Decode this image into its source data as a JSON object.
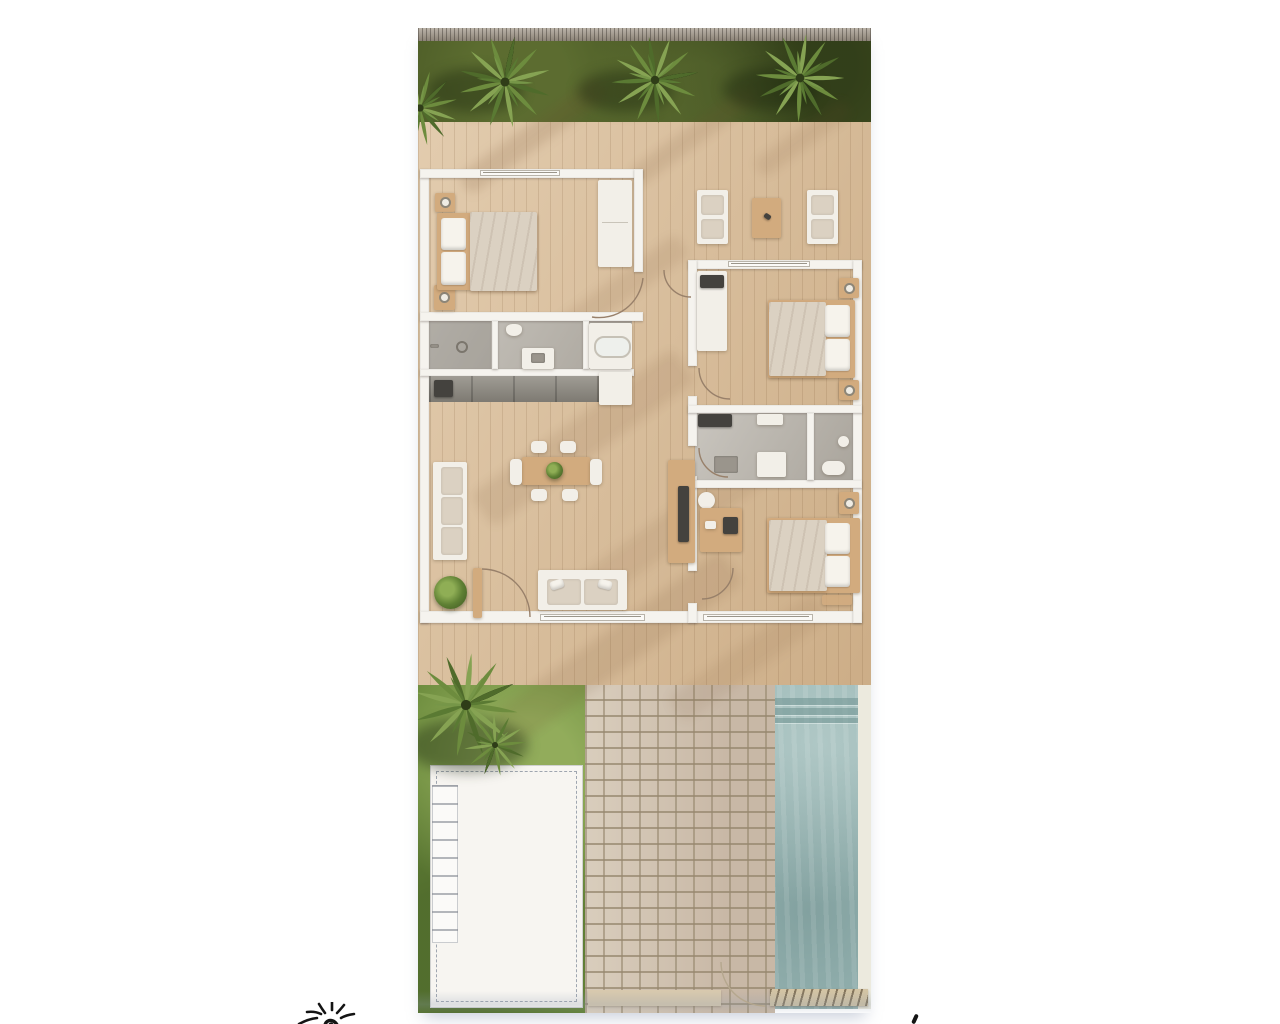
{
  "scene": {
    "type": "floor-plan-render",
    "view": "top-down-3d",
    "description": "architectural villa floor plan rendering",
    "rooms": [
      "master-bedroom",
      "bathroom-1",
      "kitchen",
      "living-dining-room",
      "hallway",
      "bedroom-2",
      "bathroom-2",
      "bedroom-3"
    ],
    "outdoor": [
      "fence",
      "garden-top",
      "wood-deck-terrace",
      "lounge-set",
      "garden-bottom",
      "parking-pad",
      "brick-patio",
      "pool"
    ],
    "palm_tree_count": 6,
    "door_arc_count": 6
  },
  "palette": {
    "fence": "#a49a8c",
    "grass_dark": "#475624",
    "grass_light": "#69893b",
    "wood_deck": "#d6b892",
    "wall": "#f5f3ee",
    "bath_floor": "#b7b2a9",
    "counter": "#8f8b82",
    "furniture_tan": "#d2ab7e",
    "furniture_white": "#f2efe8",
    "textile": "#dbd1c2",
    "pool": "#9ab7b5",
    "brick": "#ccc0ad",
    "pad": "#f7f5f1",
    "grate": "#d3c4a4",
    "palm_dark": "#4f6b2b",
    "palm_mid": "#6d8c3e",
    "palm_light": "#86a353",
    "logo_ink": "#141414"
  },
  "logo": {
    "icon": "sun-logo-icon",
    "note": "partially-cropped-hand-drawn-sun"
  }
}
